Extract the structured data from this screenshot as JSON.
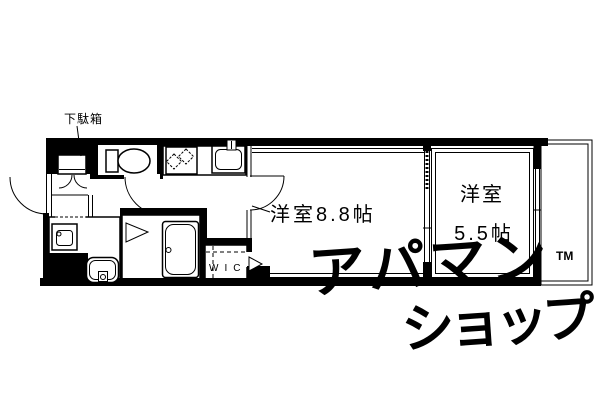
{
  "plan": {
    "shoe_cabinet_label": "下駄箱",
    "room_large_label": "洋室8.8帖",
    "room_small_label_line1": "洋室",
    "room_small_label_line2": "5.5帖",
    "wic_label": "WIC"
  },
  "watermark": {
    "line1": "アパマン",
    "tm_mark": "TM",
    "line2": "ショップ",
    "color": "#dfe3ea"
  },
  "icons": {
    "toilet": "toilet-icon",
    "washing_machine": "washing-machine-icon",
    "kitchen_sink": "kitchen-sink-icon",
    "washbasin": "washbasin-icon",
    "vanity_sink": "vanity-sink-icon",
    "bathtub": "bathtub-icon",
    "entry_door": "entry-door-arc",
    "shoe_cabinet_doors": "shoe-cabinet-door-arcs",
    "toilet_door": "toilet-door-arc",
    "room_door": "room-door-arc",
    "wic_door": "wic-door-triangle",
    "bath_folding_door": "bath-folding-door-triangle",
    "window": "window-lines",
    "balcony": "balcony-outline"
  },
  "colors": {
    "walls": "#000000",
    "background": "#ffffff"
  }
}
